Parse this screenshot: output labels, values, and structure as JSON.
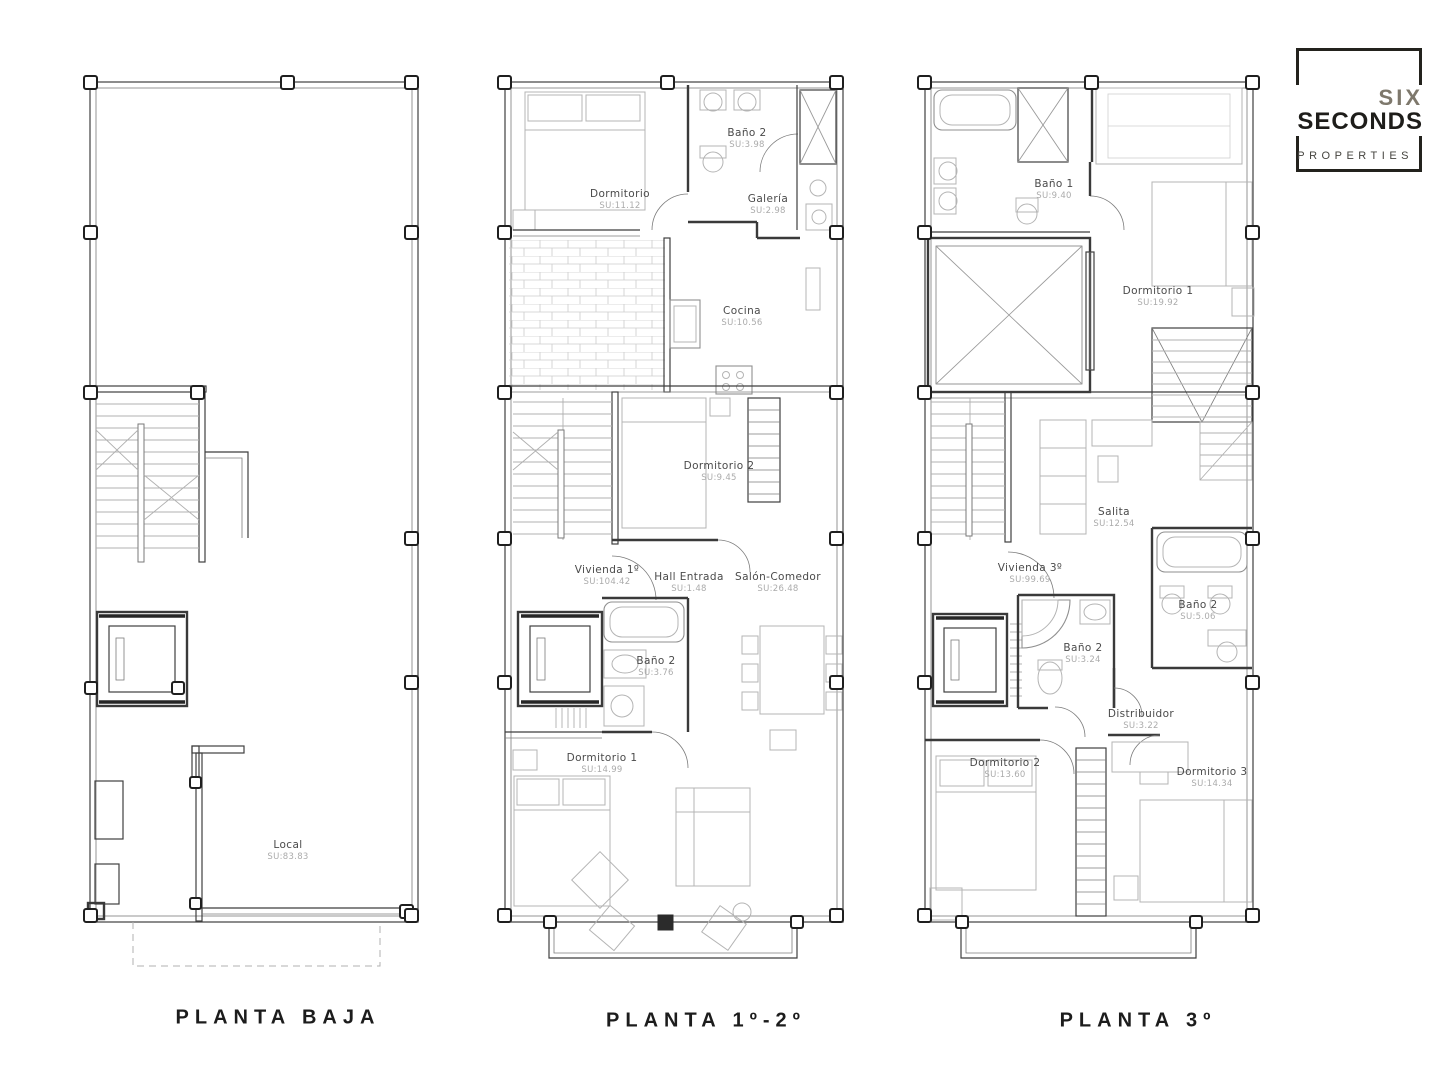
{
  "brand": {
    "line1": "SIX",
    "line2": "SECONDS",
    "line3": "PROPERTIES"
  },
  "plans": [
    {
      "id": "planta-baja",
      "title": "PLANTA BAJA",
      "rooms": [
        {
          "name": "Local",
          "area": "SU:83.83"
        }
      ]
    },
    {
      "id": "planta-1-2",
      "title": "PLANTA 1º-2º",
      "rooms": [
        {
          "name": "Dormitorio",
          "area": "SU:11.12"
        },
        {
          "name": "Baño 2",
          "area": "SU:3.98"
        },
        {
          "name": "Galería",
          "area": "SU:2.98"
        },
        {
          "name": "Cocina",
          "area": "SU:10.56"
        },
        {
          "name": "Dormitorio 2",
          "area": "SU:9.45"
        },
        {
          "name": "Vivienda 1º",
          "area": "SU:104.42"
        },
        {
          "name": "Hall Entrada",
          "area": "SU:1.48"
        },
        {
          "name": "Salón-Comedor",
          "area": "SU:26.48"
        },
        {
          "name": "Baño 2",
          "area": "SU:3.76"
        },
        {
          "name": "Dormitorio 1",
          "area": "SU:14.99"
        }
      ]
    },
    {
      "id": "planta-3",
      "title": "PLANTA 3º",
      "rooms": [
        {
          "name": "Baño 1",
          "area": "SU:9.40"
        },
        {
          "name": "Dormitorio 1",
          "area": "SU:19.92"
        },
        {
          "name": "Salita",
          "area": "SU:12.54"
        },
        {
          "name": "Vivienda 3º",
          "area": "SU:99.69"
        },
        {
          "name": "Baño 2",
          "area": "SU:3.24"
        },
        {
          "name": "Baño 2",
          "area": "SU:5.06"
        },
        {
          "name": "Distribuidor",
          "area": "SU:3.22"
        },
        {
          "name": "Dormitorio 2",
          "area": "SU:13.60"
        },
        {
          "name": "Dormitorio 3",
          "area": "SU:14.34"
        }
      ]
    }
  ]
}
